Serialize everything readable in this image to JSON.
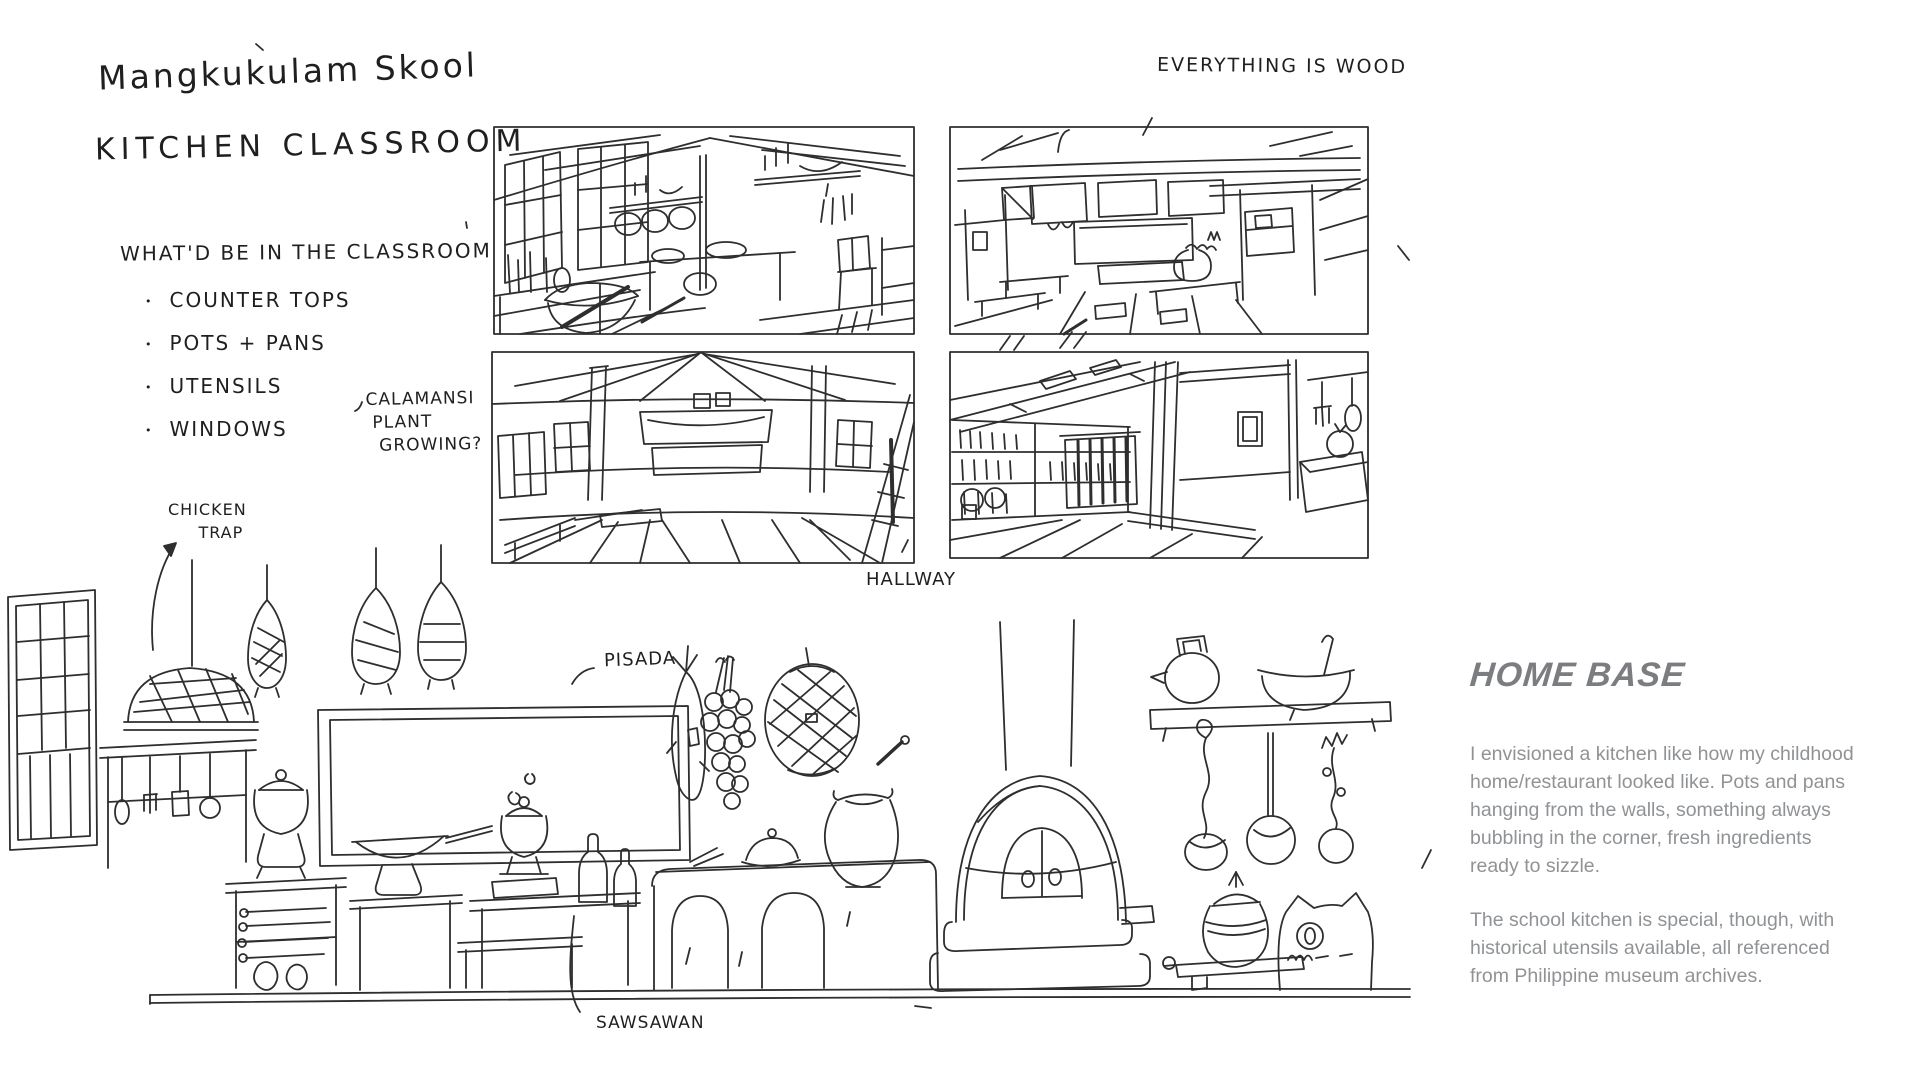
{
  "sketch": {
    "title_line1": "Mangkukulam Skool",
    "title_line2": "KITCHEN CLASSROOM",
    "list": {
      "heading": "WHAT'D BE IN THE CLASSROOM",
      "bullet": "•",
      "items": [
        "COUNTER TOPS",
        "POTS + PANS",
        "UTENSILS",
        "WINDOWS"
      ]
    },
    "annotations": {
      "everything_wood": "EVERYTHING IS WOOD",
      "calamansi": "CALAMANSI\n PLANT\n  GROWING?",
      "chicken_trap": "CHICKEN\n     TRAP",
      "hallway": "HALLWAY",
      "pisada": "PISADA",
      "sawsawan": "SAWSAWAN"
    },
    "home_base": {
      "heading": "HOME BASE",
      "paragraph1": "I envisioned a kitchen like how my childhood home/restaurant looked like. Pots and pans hanging from the walls, something always bubbling in the corner, fresh ingredients ready to sizzle.",
      "paragraph2": "The school kitchen is special, though, with historical utensils available, all referenced from Philippine museum archives."
    },
    "colors": {
      "ink": "#2e2e2e",
      "heading_gray": "#7b7d80",
      "body_gray": "#909396",
      "background": "#ffffff"
    }
  }
}
